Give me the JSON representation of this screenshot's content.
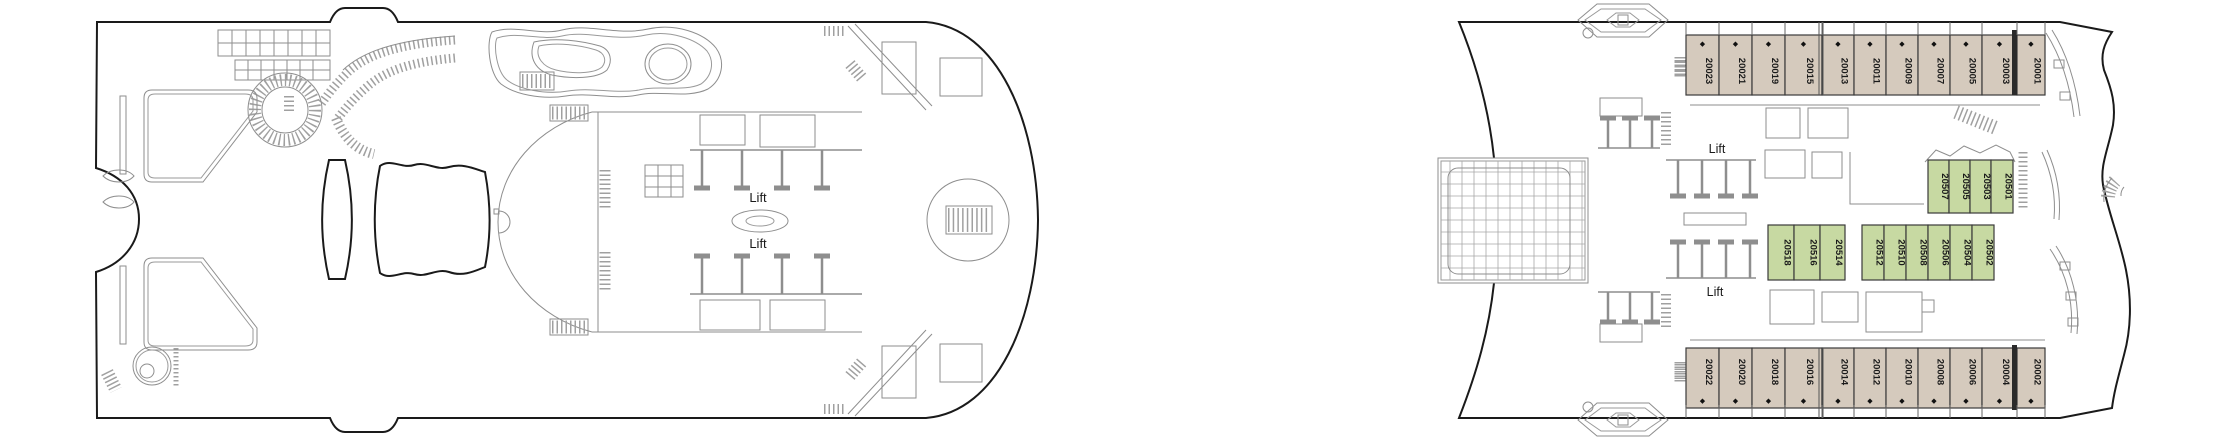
{
  "deck_plan": {
    "left_ship": {
      "lift_labels": [
        "Lift",
        "Lift"
      ]
    },
    "right_ship": {
      "lift_labels": [
        "Lift",
        "Lift"
      ],
      "cabin_rows": {
        "top": [
          "20023",
          "20021",
          "20019",
          "20015",
          "20013",
          "20011",
          "20009",
          "20007",
          "20005",
          "20003",
          "20001"
        ],
        "bottom": [
          "20022",
          "20020",
          "20018",
          "20016",
          "20014",
          "20012",
          "20010",
          "20008",
          "20006",
          "20004",
          "20002"
        ],
        "green_upper": [
          "20507",
          "20505",
          "20503",
          "20501"
        ],
        "green_mid_left": [
          "20518",
          "20516",
          "20514"
        ],
        "green_mid_right": [
          "20512",
          "20510",
          "20508",
          "20506",
          "20504",
          "20502"
        ]
      }
    },
    "symbols": {
      "diamond": "◆"
    },
    "colors": {
      "cabin_tan": "#d5cabd",
      "cabin_green": "#c7d9a2",
      "hull_outline": "#1a1a1a",
      "interior_line": "#8e8e8e",
      "cabin_border": "#3a3a3a",
      "cabin_text": "#1a1a1a"
    }
  }
}
